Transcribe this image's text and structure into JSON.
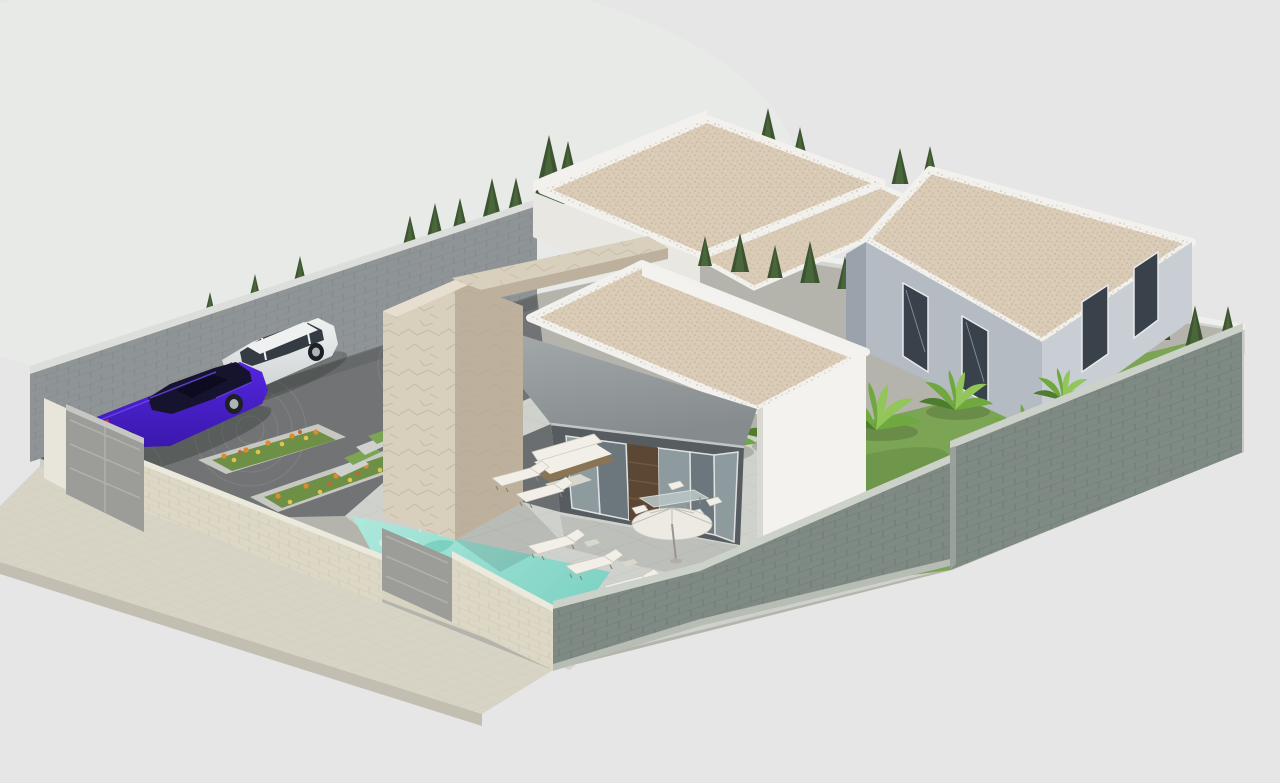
{
  "canvas": {
    "width": 1280,
    "height": 783,
    "background": "#e5e6e5"
  },
  "scene": {
    "type": "3d-architectural-render",
    "description": "Isometric 3D rendering of a modern single-storey villa plot with flat gravel roofs, stone-clad entrance volume, gray canopy awning over a glass facade, turquoise swimming pool, paved terrace with sun loungers and parasol, driveway with two parked cars, flower planters, lawn with banana plants and cypress hedges, all enclosed by perimeter walls with gates.",
    "objects": [
      "main villa",
      "rear villa",
      "right villa",
      "flat gravel roofs",
      "stone entrance volume",
      "canopy awning",
      "glass facade",
      "wood slat door",
      "swimming pool",
      "pool ladder",
      "sun loungers",
      "parasol",
      "outdoor sofa",
      "dining set",
      "driveway",
      "purple sedan",
      "white suv",
      "flower planters",
      "grass steps",
      "perimeter walls",
      "driveway gate",
      "pedestrian gate",
      "cypress trees",
      "banana plants",
      "lawn",
      "sidewalk"
    ]
  },
  "colors": {
    "bg": "#e5e6e5",
    "bg_glow": "#ecedec",
    "wall_back_face": "#8f9497",
    "wall_back_joint": "#7b8084",
    "wall_back_coping": "#dcdedb",
    "wall_far_face": "#d3d5d1",
    "wall_far_coping": "#eef0ed",
    "wall_green": "#7e8a83",
    "wall_green_joint": "#68736d",
    "wall_green_coping": "#ccd1ca",
    "wall_green_curb": "#b7bcb5",
    "front_wall_beige": "#ddd8c6",
    "front_wall_joint": "#c6bfab",
    "front_wall_coping": "#ebe8dc",
    "gate_gray": "#9c9c98",
    "gate_rail": "#b0b0ac",
    "gate_pillar": "#e8e5da",
    "sidewalk": "#d7d3c5",
    "sidewalk_curb": "#c2beb1",
    "driveway": "#717375",
    "driveway_arc": "#8a8c8e",
    "ground_base": "#b5b4ac",
    "terrace": "#cfd1cc",
    "terrace_joint": "#b9bcb6",
    "grass": "#7ba454",
    "grass_dark": "#628c43",
    "pool_coping": "#d8d2c0",
    "water_light": "#aee9dc",
    "water_main": "#7fd3c4",
    "water_deep": "#58bcab",
    "water_caustic": "#e9fcf6",
    "chrome": "#d9dde0",
    "planter_edge": "#c8c8c2",
    "planter_soil": "#6d9046",
    "flower_orange": "#df8a2e",
    "flower_yellow": "#e6c14e",
    "flower_red": "#c9642a",
    "roof_gravel": "#d9cbb6",
    "roof_gravel_dot": "#b9a78e",
    "roof_gravel_dot2": "#e9decb",
    "white_parapet": "#f2f1ed",
    "white_wall_bright": "#f3f2ee",
    "white_wall_mid": "#e9e7e2",
    "awning_light": "#a8adae",
    "awning_dark": "#868c8e",
    "awning_edge": "#c2c5c5",
    "interior_dark": "#565c60",
    "glass_light": "#8d9a9e",
    "glass_dark": "#6b777c",
    "mullion": "#dfe1e0",
    "door_wood": "#5b4733",
    "door_slat": "#70593f",
    "stone_light": "#d8cfbd",
    "stone_dark": "#bdb19d",
    "stone_top": "#e6dfd0",
    "stone_crack": "#a99c85",
    "right_wall": "#b4bbc3",
    "right_wall_light": "#c9ced4",
    "right_wall_shade": "#9aa2ab",
    "window_dark": "#39414b",
    "window_frame": "#e8eaec",
    "cypress_dark": "#3d5431",
    "cypress_light": "#4e6b3e",
    "banana_main": "#6fa83e",
    "banana_light": "#93c65a",
    "banana_dark": "#4f7d2e",
    "furniture_white": "#f1efe8",
    "furniture_frame": "#8a7456",
    "table_glass": "#b9c4c4",
    "parasol_light": "#eceae3",
    "parasol_mid": "#d9d6cc",
    "sedan_light": "#5326df",
    "sedan_dark": "#3a18ad",
    "sedan_glass": "#16132e",
    "suv_body": "#eff1f1",
    "suv_shade": "#cfd3d4",
    "suv_glass": "#343b43",
    "wheel_dark": "#1d2125",
    "rim": "#aeb3b8",
    "taillight": "#d1342a",
    "shadow": "#1c241c"
  }
}
